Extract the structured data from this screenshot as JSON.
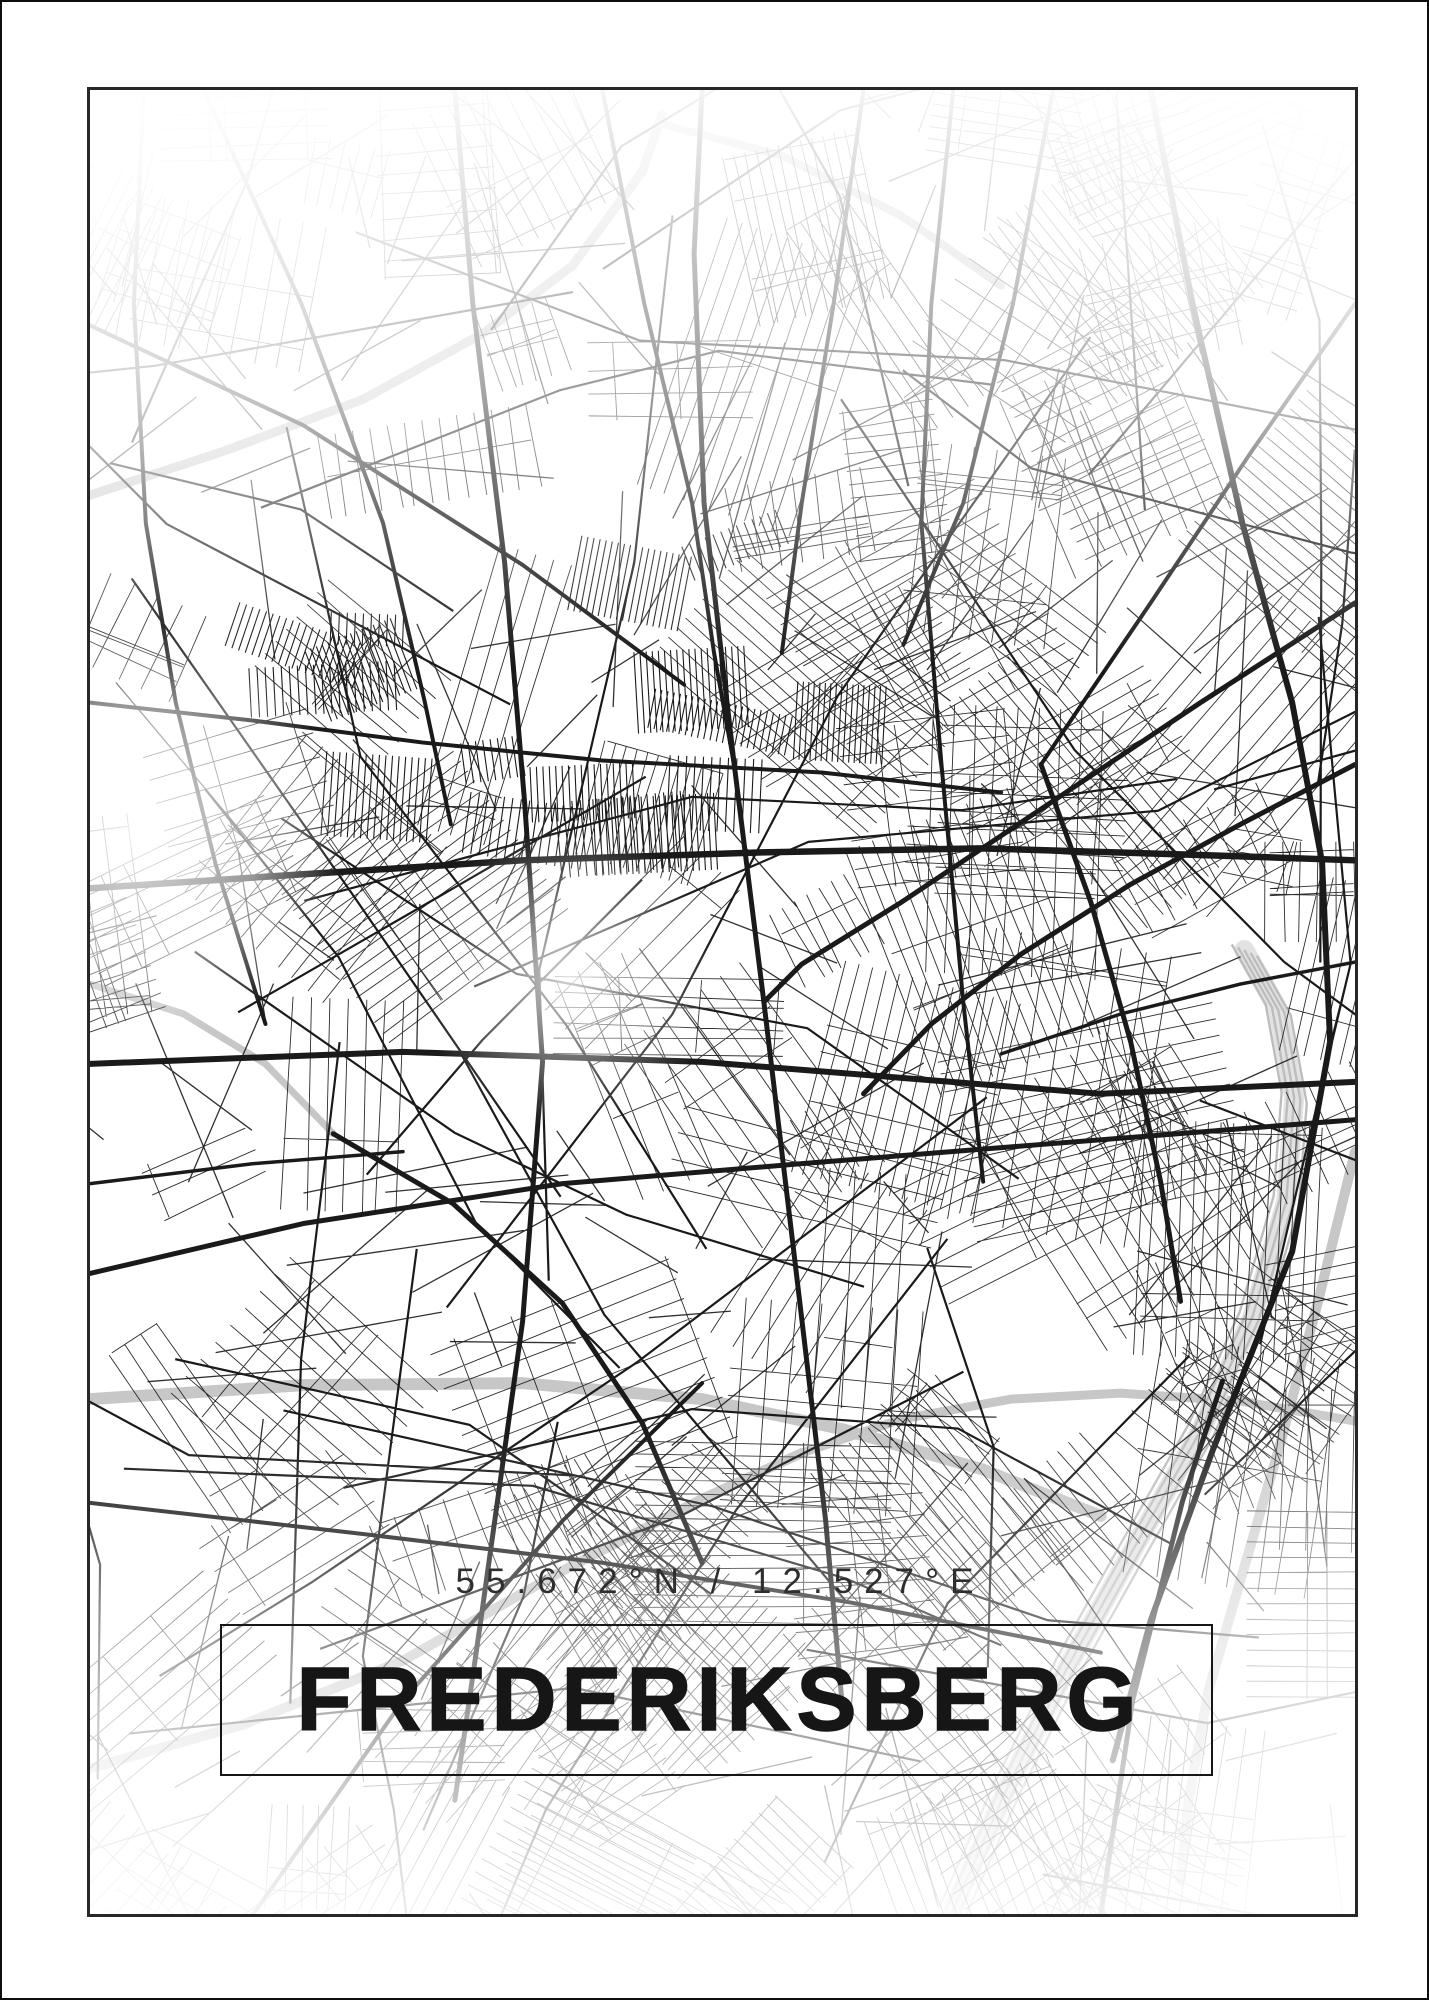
{
  "poster": {
    "title": "FREDERIKSBERG",
    "coordinates": "55.672°N / 12.527°E",
    "colors": {
      "background": "#ffffff",
      "outer_border": "#0d0d0d",
      "frame_border": "#272727",
      "street_black": "#1a1a1a",
      "artery_gray": "#c7c7c7",
      "rail_gray": "#bdbdbd",
      "rail_band": "#e2e2e2",
      "title_text": "#161616",
      "coords_text": "#2e2e2e"
    }
  },
  "map": {
    "seed": 20240672,
    "texture": {
      "clusters": 115,
      "dense_blocks": 16,
      "connectors": 175,
      "medium_roads": 48
    },
    "gray_arteries": [
      {
        "w": 12,
        "pts": [
          [
            86,
            1398
          ],
          [
            300,
            1384
          ],
          [
            520,
            1382
          ],
          [
            700,
            1398
          ],
          [
            840,
            1428
          ],
          [
            980,
            1468
          ],
          [
            1100,
            1515
          ]
        ]
      },
      {
        "w": 10,
        "pts": [
          [
            86,
            1768
          ],
          [
            240,
            1724
          ],
          [
            400,
            1660
          ],
          [
            560,
            1570
          ],
          [
            700,
            1498
          ],
          [
            800,
            1452
          ]
        ]
      },
      {
        "w": 9,
        "pts": [
          [
            86,
            492
          ],
          [
            220,
            448
          ],
          [
            360,
            396
          ],
          [
            480,
            330
          ],
          [
            570,
            262
          ],
          [
            640,
            168
          ],
          [
            660,
            110
          ]
        ]
      },
      {
        "w": 8,
        "pts": [
          [
            660,
            120
          ],
          [
            780,
            152
          ],
          [
            900,
            212
          ],
          [
            1000,
            282
          ]
        ]
      },
      {
        "w": 10,
        "pts": [
          [
            1355,
            1150
          ],
          [
            1318,
            1300
          ],
          [
            1278,
            1450
          ],
          [
            1240,
            1580
          ],
          [
            1208,
            1690
          ],
          [
            1188,
            1800
          ],
          [
            1180,
            1880
          ]
        ]
      },
      {
        "w": 7,
        "pts": [
          [
            86,
            982
          ],
          [
            180,
            1012
          ],
          [
            262,
            1062
          ],
          [
            330,
            1132
          ]
        ]
      },
      {
        "w": 9,
        "pts": [
          [
            800,
            1452
          ],
          [
            900,
            1418
          ],
          [
            1010,
            1398
          ],
          [
            1120,
            1392
          ],
          [
            1240,
            1400
          ],
          [
            1355,
            1420
          ]
        ]
      }
    ],
    "rail": {
      "w": 2.4,
      "band_w": 20,
      "offsets": [
        -14,
        -7,
        0,
        7,
        14
      ],
      "pts": [
        [
          950,
          1914
        ],
        [
          1006,
          1788
        ],
        [
          1068,
          1664
        ],
        [
          1134,
          1546
        ],
        [
          1200,
          1430
        ],
        [
          1252,
          1316
        ],
        [
          1286,
          1200
        ],
        [
          1294,
          1096
        ],
        [
          1278,
          1008
        ],
        [
          1244,
          948
        ]
      ]
    },
    "major_roads": [
      {
        "w": 6.5,
        "pts": [
          [
            86,
            886
          ],
          [
            300,
            872
          ],
          [
            520,
            858
          ],
          [
            760,
            850
          ],
          [
            980,
            846
          ],
          [
            1180,
            852
          ],
          [
            1355,
            858
          ]
        ]
      },
      {
        "w": 6,
        "pts": [
          [
            86,
            1062
          ],
          [
            400,
            1050
          ],
          [
            700,
            1060
          ],
          [
            900,
            1076
          ],
          [
            1100,
            1092
          ],
          [
            1355,
            1080
          ]
        ]
      },
      {
        "w": 4,
        "pts": [
          [
            86,
            700
          ],
          [
            250,
            718
          ],
          [
            420,
            740
          ],
          [
            600,
            758
          ],
          [
            820,
            770
          ],
          [
            1000,
            790
          ]
        ]
      },
      {
        "w": 5,
        "pts": [
          [
            452,
            86
          ],
          [
            470,
            300
          ],
          [
            502,
            560
          ],
          [
            522,
            800
          ],
          [
            540,
            1060
          ],
          [
            520,
            1320
          ],
          [
            478,
            1620
          ],
          [
            452,
            1800
          ]
        ]
      },
      {
        "w": 5,
        "pts": [
          [
            700,
            86
          ],
          [
            692,
            250
          ],
          [
            702,
            500
          ],
          [
            732,
            760
          ],
          [
            762,
            1000
          ],
          [
            792,
            1250
          ],
          [
            824,
            1520
          ],
          [
            842,
            1720
          ]
        ]
      },
      {
        "w": 4,
        "pts": [
          [
            952,
            86
          ],
          [
            930,
            300
          ],
          [
            920,
            520
          ],
          [
            940,
            760
          ],
          [
            962,
            1000
          ],
          [
            982,
            1180
          ]
        ]
      },
      {
        "w": 5,
        "pts": [
          [
            86,
            1272
          ],
          [
            300,
            1222
          ],
          [
            560,
            1182
          ],
          [
            800,
            1162
          ],
          [
            1050,
            1142
          ],
          [
            1355,
            1118
          ]
        ]
      },
      {
        "w": 4,
        "pts": [
          [
            200,
            86
          ],
          [
            298,
            300
          ],
          [
            380,
            520
          ],
          [
            422,
            700
          ],
          [
            448,
            822
          ]
        ]
      },
      {
        "w": 5,
        "pts": [
          [
            1355,
            600
          ],
          [
            1200,
            700
          ],
          [
            1050,
            800
          ],
          [
            900,
            900
          ],
          [
            800,
            962
          ],
          [
            762,
            1000
          ]
        ]
      },
      {
        "w": 4,
        "pts": [
          [
            1355,
            300
          ],
          [
            1250,
            450
          ],
          [
            1150,
            600
          ],
          [
            1082,
            700
          ],
          [
            1040,
            762
          ]
        ]
      },
      {
        "w": 6,
        "pts": [
          [
            1150,
            86
          ],
          [
            1192,
            300
          ],
          [
            1242,
            520
          ],
          [
            1292,
            700
          ],
          [
            1322,
            860
          ],
          [
            1330,
            1040
          ],
          [
            1292,
            1250
          ],
          [
            1212,
            1450
          ],
          [
            1150,
            1620
          ],
          [
            1112,
            1760
          ]
        ]
      },
      {
        "w": 4,
        "pts": [
          [
            250,
            1914
          ],
          [
            400,
            1700
          ],
          [
            560,
            1520
          ],
          [
            700,
            1382
          ]
        ]
      },
      {
        "w": 4,
        "pts": [
          [
            86,
            1502
          ],
          [
            350,
            1532
          ],
          [
            600,
            1562
          ],
          [
            850,
            1602
          ],
          [
            1100,
            1652
          ]
        ]
      },
      {
        "w": 5,
        "pts": [
          [
            1100,
            1914
          ],
          [
            1132,
            1700
          ],
          [
            1182,
            1500
          ],
          [
            1222,
            1380
          ]
        ]
      },
      {
        "w": 4,
        "pts": [
          [
            86,
            322
          ],
          [
            300,
            422
          ],
          [
            520,
            562
          ],
          [
            682,
            682
          ]
        ]
      },
      {
        "w": 4,
        "pts": [
          [
            600,
            86
          ],
          [
            642,
            300
          ],
          [
            690,
            500
          ],
          [
            712,
            650
          ],
          [
            732,
            762
          ]
        ]
      },
      {
        "w": 4,
        "pts": [
          [
            862,
            86
          ],
          [
            832,
            300
          ],
          [
            800,
            500
          ],
          [
            780,
            650
          ]
        ]
      },
      {
        "w": 4,
        "pts": [
          [
            1052,
            86
          ],
          [
            1012,
            300
          ],
          [
            962,
            500
          ],
          [
            902,
            642
          ]
        ]
      },
      {
        "w": 3.5,
        "pts": [
          [
            86,
            1182
          ],
          [
            250,
            1162
          ],
          [
            400,
            1150
          ]
        ]
      },
      {
        "w": 5,
        "pts": [
          [
            330,
            1132
          ],
          [
            450,
            1202
          ],
          [
            560,
            1302
          ],
          [
            640,
            1422
          ],
          [
            700,
            1562
          ]
        ]
      },
      {
        "w": 3.5,
        "pts": [
          [
            1355,
            960
          ],
          [
            1240,
            982
          ],
          [
            1120,
            1012
          ],
          [
            1000,
            1052
          ]
        ]
      },
      {
        "w": 4,
        "pts": [
          [
            140,
            86
          ],
          [
            130,
            300
          ],
          [
            142,
            520
          ],
          [
            172,
            700
          ],
          [
            212,
            862
          ],
          [
            262,
            1022
          ]
        ]
      },
      {
        "w": 5,
        "pts": [
          [
            1040,
            762
          ],
          [
            1090,
            900
          ],
          [
            1130,
            1040
          ],
          [
            1160,
            1180
          ],
          [
            1180,
            1300
          ]
        ]
      },
      {
        "w": 5,
        "pts": [
          [
            1355,
            762
          ],
          [
            1240,
            822
          ],
          [
            1130,
            882
          ],
          [
            1020,
            952
          ],
          [
            930,
            1022
          ],
          [
            862,
            1092
          ]
        ]
      }
    ]
  }
}
